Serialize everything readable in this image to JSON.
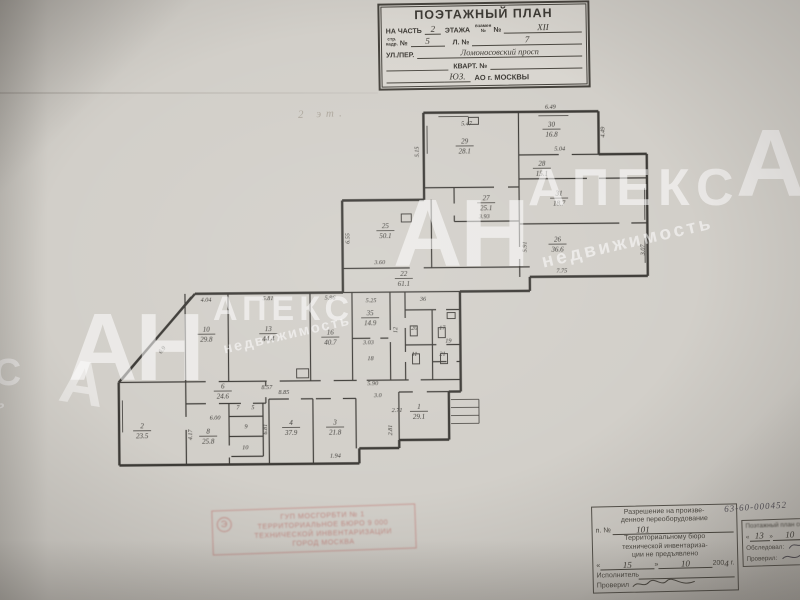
{
  "watermark": {
    "short": "АН",
    "name": "АПЕКС",
    "sub": "недвижимость",
    "fragment_left": "КС",
    "fragment_left2": "мость",
    "fragment_letter": "А"
  },
  "pencil_note": "2 эт.",
  "title_block": {
    "title": "ПОЭТАЖНЫЙ ПЛАН",
    "part_label": "НА ЧАСТЬ",
    "part_value": "2",
    "floor_label": "ЭТАЖА",
    "floor_sub1": "взамен",
    "floor_sub2": "№",
    "floor_no_label": "№",
    "floor_value": "XII",
    "str_sub1": "стр.",
    "str_sub2": "кадр.",
    "str_no_label": "№",
    "str_value": "5",
    "sheet_label": "Л. №",
    "sheet_value": "7",
    "street_label": "УЛ./ПЕР.",
    "street_value": "Ломоносовский просп",
    "kvart_label": "КВАРТ. №",
    "okrug_value": "ЮЗ.",
    "okrug_label": "АО г. МОСКВЫ"
  },
  "plan": {
    "ink": "#3c3a36",
    "rooms": [
      {
        "n": "29",
        "a": "28.1",
        "x": 466,
        "y": 144
      },
      {
        "n": "30",
        "a": "16.8",
        "x": 553,
        "y": 128
      },
      {
        "n": "28",
        "a": "15.1",
        "x": 543,
        "y": 167
      },
      {
        "n": "31",
        "a": "18.7",
        "x": 560,
        "y": 197
      },
      {
        "n": "27",
        "a": "25.1",
        "x": 487,
        "y": 201
      },
      {
        "n": "26",
        "a": "36.6",
        "x": 558,
        "y": 243
      },
      {
        "n": "25",
        "a": "50.1",
        "x": 386,
        "y": 228
      },
      {
        "n": "22",
        "a": "61.1",
        "x": 404,
        "y": 276
      },
      {
        "n": "10",
        "a": "29.8",
        "x": 206,
        "y": 330
      },
      {
        "n": "13",
        "a": "44.4",
        "x": 268,
        "y": 330
      },
      {
        "n": "16",
        "a": "40.7",
        "x": 330,
        "y": 334
      },
      {
        "n": "35",
        "a": "14.9",
        "x": 370,
        "y": 315
      },
      {
        "n": "18",
        "x": 370,
        "y": 360
      },
      {
        "n": "12",
        "x": 397,
        "y": 330,
        "r": -90
      },
      {
        "n": "36",
        "x": 423,
        "y": 301
      },
      {
        "n": "20",
        "x": 414,
        "y": 330
      },
      {
        "n": "17",
        "x": 442,
        "y": 330
      },
      {
        "n": "19",
        "x": 448,
        "y": 343
      },
      {
        "n": "11",
        "x": 414,
        "y": 356
      },
      {
        "n": "21",
        "x": 442,
        "y": 356
      },
      {
        "n": "2",
        "a": "23.5",
        "x": 141,
        "y": 426
      },
      {
        "n": "6",
        "a": "24.6",
        "x": 222,
        "y": 387
      },
      {
        "n": "8",
        "a": "25.8",
        "x": 207,
        "y": 432
      },
      {
        "n": "7",
        "x": 237,
        "y": 408
      },
      {
        "n": "5",
        "x": 252,
        "y": 408
      },
      {
        "n": "9",
        "x": 245,
        "y": 427
      },
      {
        "n": "10",
        "x": 244,
        "y": 448
      },
      {
        "n": "4",
        "a": "37.9",
        "x": 290,
        "y": 424
      },
      {
        "n": "3",
        "a": "21.8",
        "x": 334,
        "y": 424
      },
      {
        "n": "1",
        "a": "29.1",
        "x": 418,
        "y": 409
      }
    ],
    "dims": [
      {
        "t": "5.47",
        "x": 468,
        "y": 126
      },
      {
        "t": "6.49",
        "x": 552,
        "y": 110
      },
      {
        "t": "4.49",
        "x": 606,
        "y": 134,
        "r": -90
      },
      {
        "t": "5.15",
        "x": 420,
        "y": 152,
        "r": -90
      },
      {
        "t": "5.04",
        "x": 561,
        "y": 152
      },
      {
        "t": "3.93",
        "x": 485,
        "y": 219
      },
      {
        "t": "6.55",
        "x": 350,
        "y": 238,
        "r": -90
      },
      {
        "t": "3.60",
        "x": 380,
        "y": 264
      },
      {
        "t": "7.75",
        "x": 562,
        "y": 274
      },
      {
        "t": "3.07",
        "x": 645,
        "y": 252,
        "r": -90
      },
      {
        "t": "5.91",
        "x": 527,
        "y": 248,
        "r": -90
      },
      {
        "t": "4.04",
        "x": 206,
        "y": 300
      },
      {
        "t": "5.81",
        "x": 268,
        "y": 299
      },
      {
        "t": "5.96",
        "x": 330,
        "y": 299
      },
      {
        "t": "5.25",
        "x": 371,
        "y": 302
      },
      {
        "t": "3.03",
        "x": 368,
        "y": 344
      },
      {
        "t": "8.57",
        "x": 266,
        "y": 388
      },
      {
        "t": "5.90",
        "x": 372,
        "y": 385
      },
      {
        "t": "6.9",
        "x": 163,
        "y": 349,
        "r": -49
      },
      {
        "t": "6.00",
        "x": 214,
        "y": 418
      },
      {
        "t": "4.17",
        "x": 191,
        "y": 433,
        "r": -90
      },
      {
        "t": "8.85",
        "x": 283,
        "y": 393
      },
      {
        "t": "6.81",
        "x": 266,
        "y": 428,
        "r": -90
      },
      {
        "t": "1.94",
        "x": 334,
        "y": 457
      },
      {
        "t": "2.71",
        "x": 396,
        "y": 412
      },
      {
        "t": "3.0",
        "x": 377,
        "y": 397
      },
      {
        "t": "2.81",
        "x": 391,
        "y": 430,
        "r": -90
      }
    ]
  },
  "stamp_red": {
    "badge": "Э",
    "lines": [
      "ГУП МОСГОРБТИ  № 1",
      "ТЕРРИТОРИАЛЬНОЕ БЮРО 9 000",
      "ТЕХНИЧЕСКОЙ ИНВЕНТАРИЗАЦИИ",
      "ГОРОД МОСКВА"
    ]
  },
  "stamp_permit": {
    "lines": [
      "Разрешение на произве-",
      "денное переоборудование"
    ],
    "doc_label": "п.",
    "doc_no_label": "№",
    "doc_value": "101",
    "body": [
      "Территориальному бюро",
      "технической инвентариза-",
      "ции не предъявлено"
    ],
    "date_open": "«",
    "date_day": "15",
    "date_close": "»",
    "date_month": "10",
    "date_year": "200",
    "date_year2": "4",
    "date_suffix": "г.",
    "executor_label": "Исполнитель",
    "checked_label": "Проверил"
  },
  "stamp_survey": {
    "number": "63-60-000452",
    "line1": "Поэтажный план составлен",
    "date_open": "«",
    "date_day": "13",
    "date_close": "»",
    "date_month": "10",
    "surveyed_label": "Обследовал:",
    "checked_label": "Проверил:"
  }
}
